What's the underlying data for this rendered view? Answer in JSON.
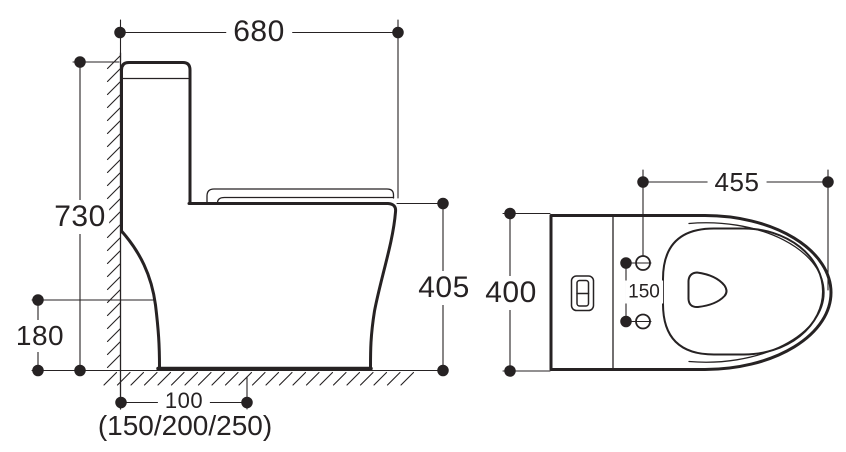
{
  "drawing": {
    "type": "toilet-installation-dimension-diagram",
    "units_implied": "mm",
    "line_color": "#262223",
    "background_color": "#ffffff",
    "side_view": {
      "overall_width": "680",
      "overall_height": "730",
      "bowl_rim_height": "405",
      "outlet_center_height": "180",
      "rough_in_distance": "100",
      "rough_in_options": "(150/200/250)"
    },
    "top_view": {
      "seat_length": "455",
      "overall_width": "400",
      "bolt_hole_spacing": "150"
    }
  }
}
